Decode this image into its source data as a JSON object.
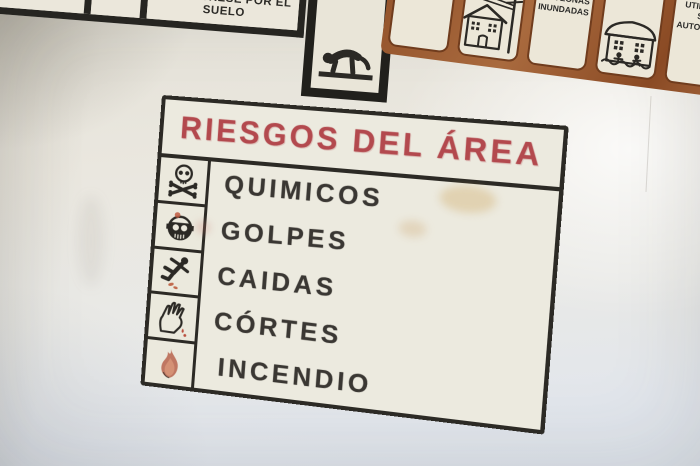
{
  "scene": {
    "description": "Hand-painted safety signs on a wall",
    "wall_color": "#e9e7e1",
    "ink_color": "#2c2a25"
  },
  "upper_left_sign": {
    "instruction_text": "ARRASTRESE POR EL SUELO",
    "pictogram": "crawling-person"
  },
  "upper_right_sign": {
    "grout_color": "#9a5a33",
    "tiles": [
      {
        "kind": "text",
        "text": "ERQUE A CABLES DE ELECTRICIDAD"
      },
      {
        "kind": "pictogram",
        "icon": "house-power-line"
      },
      {
        "kind": "text",
        "text": "8 EVITE CAMINAR POR ZONAS INUNDADAS"
      },
      {
        "kind": "pictogram",
        "icon": "house-flood"
      },
      {
        "kind": "text",
        "text": "9 EVITE UTILIZAR SU AUTOMOVIL"
      }
    ]
  },
  "main_sign": {
    "title": "RIESGOS DEL ÁREA",
    "title_color": "#b3494e",
    "items": [
      {
        "label": "QUIMICOS",
        "icon": "skull-crossbones"
      },
      {
        "label": "GOLPES",
        "icon": "bumped-head"
      },
      {
        "label": "CAIDAS",
        "icon": "slipping-person"
      },
      {
        "label": "CÓRTES",
        "icon": "cut-hand"
      },
      {
        "label": "INCENDIO",
        "icon": "flame"
      }
    ]
  }
}
